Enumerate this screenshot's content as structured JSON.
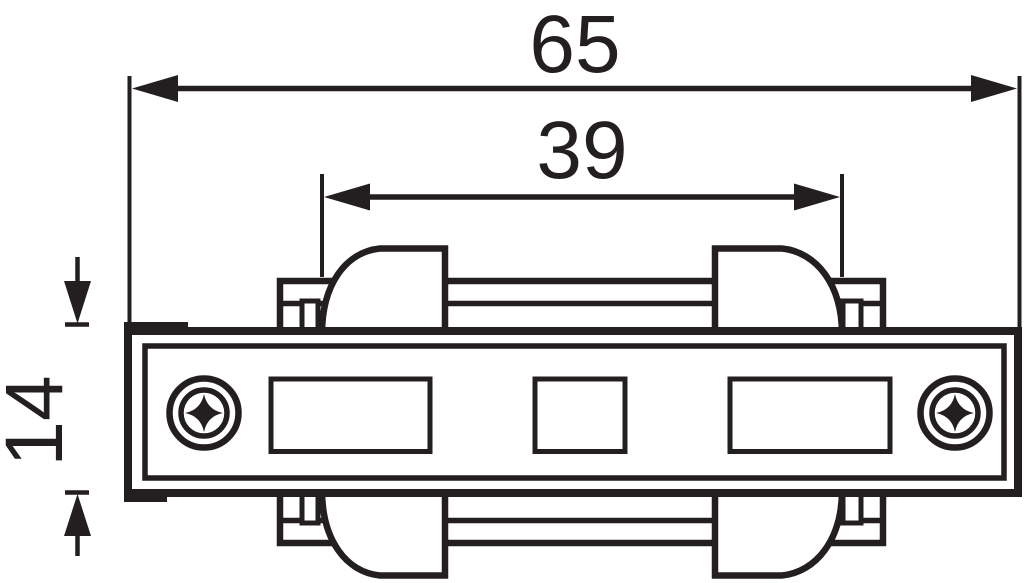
{
  "dimensions": {
    "overall_width": "65",
    "inner_span": "39",
    "body_height": "14"
  },
  "colors": {
    "line": "#231f20",
    "background": "#ffffff"
  }
}
